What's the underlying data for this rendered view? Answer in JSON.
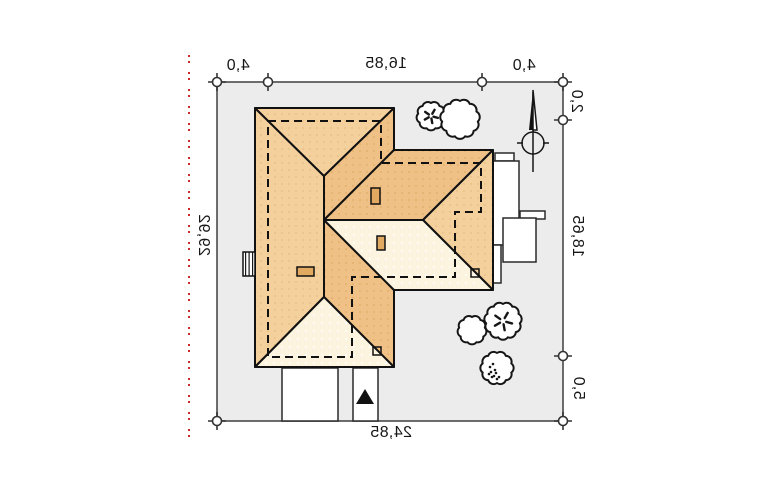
{
  "drawing": {
    "type": "house-roof-site-plan",
    "dimensions": {
      "top_left": "4,0",
      "top_middle": "16,85",
      "top_right": "4,0",
      "right_top": "2,0",
      "right_middle": "18,65",
      "right_bottom": "5,0",
      "left_side": "29,92",
      "bottom": "24,85"
    },
    "text_note": "all dimension labels are rendered mirrored in the source image"
  },
  "colors": {
    "plot_fill": "#ececec",
    "plot_stroke": "#4a4a4a",
    "line_dark": "#161616",
    "roof_medium": "#f4d09d",
    "roof_medium_dot": "#e5bd83",
    "roof_dark": "#efc187",
    "roof_dark_dot": "#dfab64",
    "roof_light": "#fdf4e0",
    "roof_light_dot": "#ffffff",
    "chimney_fill": "#e2aa61",
    "offset_red": "#cc2a2a"
  }
}
